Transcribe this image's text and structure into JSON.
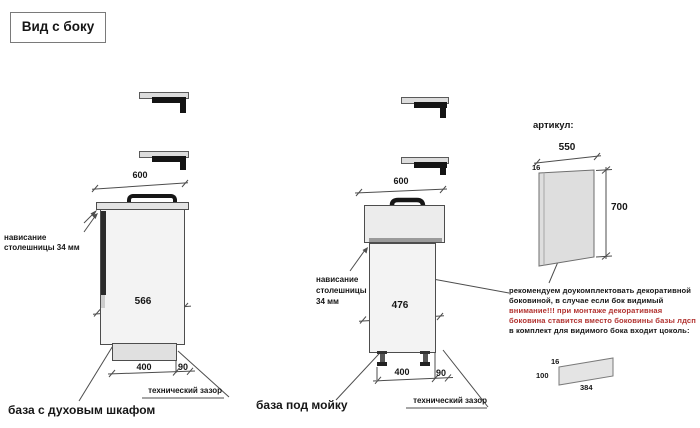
{
  "title": "Вид с боку",
  "left": {
    "dim_top": "600",
    "dim_depth": "566",
    "dim_a": "400",
    "dim_b": "90",
    "overhang_line1": "нависание",
    "overhang_line2": "столешницы 34 мм",
    "tech_gap": "технический зазор",
    "caption": "база с духовым шкафом"
  },
  "middle": {
    "dim_top": "600",
    "dim_depth": "476",
    "dim_a": "400",
    "dim_b": "90",
    "overhang_line1": "нависание",
    "overhang_line2": "столешницы",
    "overhang_line3": "34 мм",
    "tech_gap": "технический зазор",
    "caption": "база под мойку"
  },
  "panel": {
    "articul": "артикул:",
    "dim_width": "550",
    "dim_thickness": "16",
    "dim_height": "700",
    "note1": "рекомендуем доукомплектовать декоративной",
    "note2": "боковиной, в случае если бок видимый",
    "warn1": "внимание!!! при монтаже декоративная",
    "warn2": "боковина ставится вместо боковины базы лдсп",
    "note3": "в комплект для видимого бока входит цоколь:"
  },
  "plinth_panel": {
    "dim_thickness": "16",
    "dim_height": "100",
    "dim_length": "384"
  },
  "colors": {
    "warning_red": "#b23330",
    "line_grey": "#4d4d4d",
    "fill_grey": "#e0e0e0"
  }
}
